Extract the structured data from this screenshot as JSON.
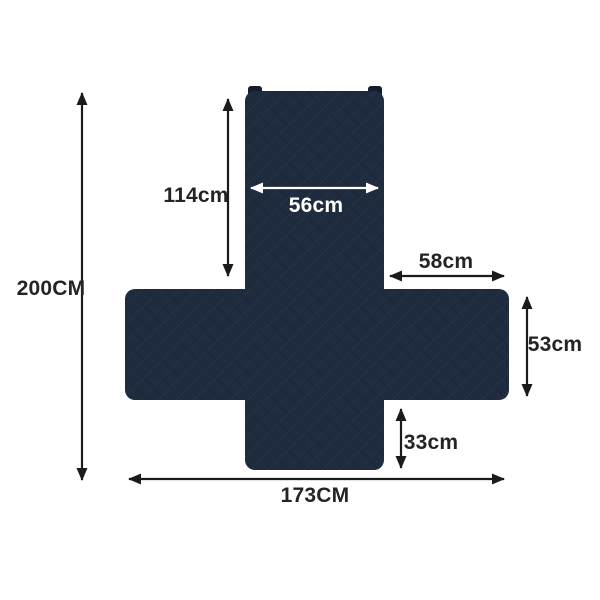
{
  "figure": {
    "name": "sofa-cover-dimension-diagram",
    "background_color": "#ffffff",
    "fabric_color": "#1f2b3e",
    "fabric_texture_light": "#2a374e",
    "fabric_texture_dark": "#1a2433",
    "strap_tab_color": "#141e2c",
    "arrow_color": "#1b1b1b",
    "label_color": "#242424",
    "inner_arrow_color": "#ffffff",
    "measurements": {
      "overall_height": "200CM",
      "back_height": "114cm",
      "back_width": "56cm",
      "arm_length": "58cm",
      "arm_height": "53cm",
      "front_skirt_height": "33cm",
      "overall_width": "173CM"
    }
  }
}
